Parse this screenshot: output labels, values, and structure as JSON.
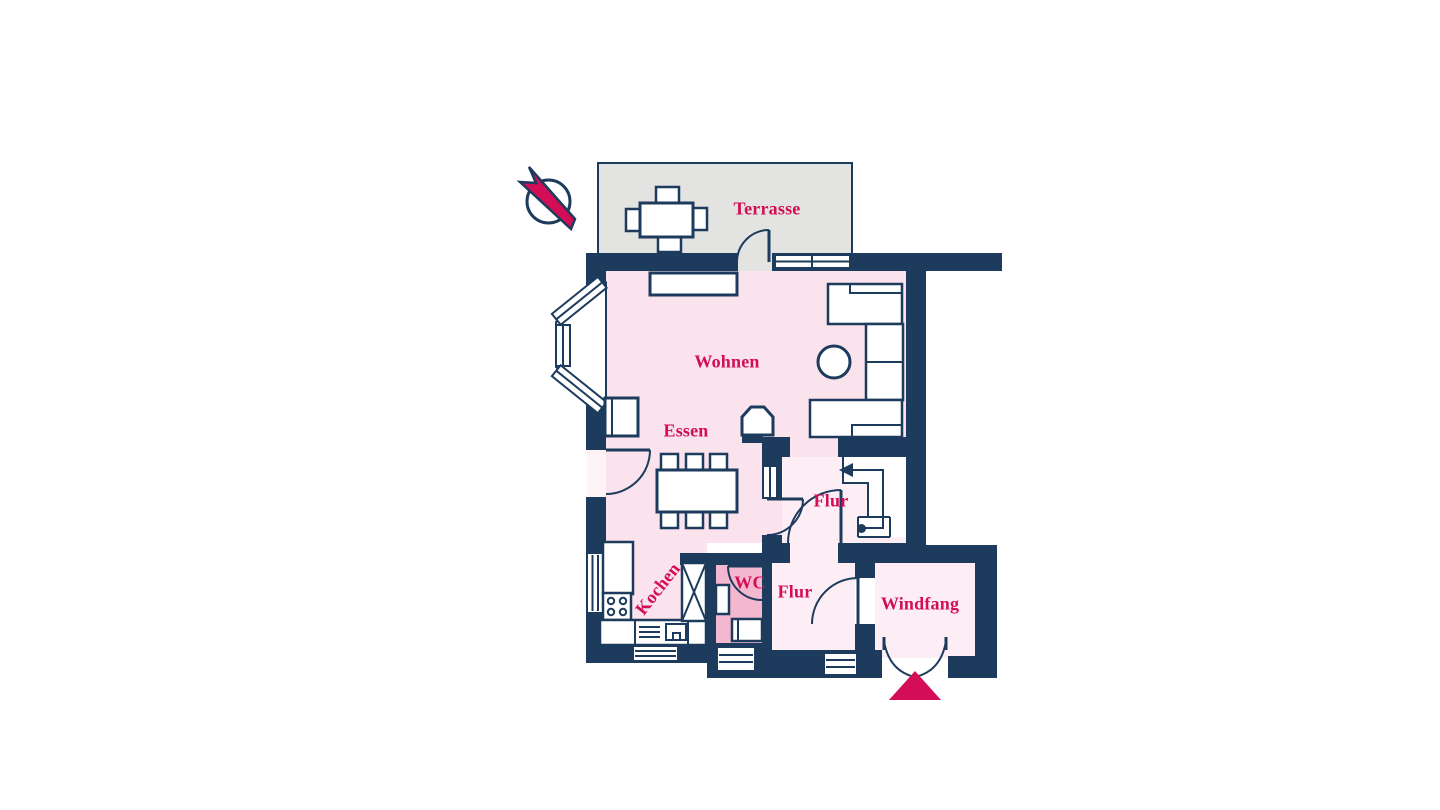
{
  "rooms": {
    "terrasse": {
      "label": "Terrasse"
    },
    "wohnen": {
      "label": "Wohnen"
    },
    "essen": {
      "label": "Essen"
    },
    "kochen": {
      "label": "Kochen"
    },
    "wc": {
      "label": "WC"
    },
    "flur_upper": {
      "label": "Flur"
    },
    "flur_lower": {
      "label": "Flur"
    },
    "windfang": {
      "label": "Windfang"
    }
  },
  "icons": {
    "north_indicator": "north-arrow-through-circle",
    "entrance_marker": "triangle-arrow-up"
  },
  "colors": {
    "navy": "#1d3b5d",
    "crimson": "#d30d56",
    "room_pink": "#fbe3ed",
    "hall_pink": "#fdedf4",
    "wc_pink": "#f3b8cf",
    "terrace_gray": "#e3e3e2",
    "opening_pink": "#fdf2f6"
  }
}
